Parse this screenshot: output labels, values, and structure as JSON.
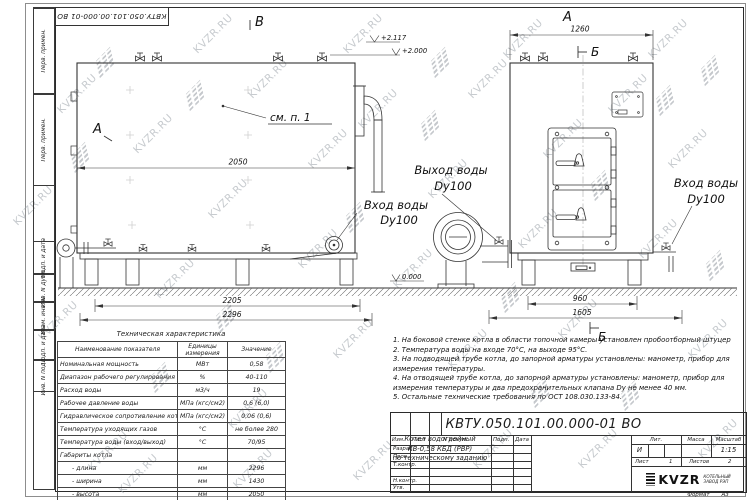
{
  "watermark": {
    "text": "KVZR.RU"
  },
  "frame_labels": {
    "perv_primen_1": "Перв. примен.",
    "perv_primen_2": "Перв. примен.",
    "podp_data_1": "Подп. и дата",
    "inv_dubl": "Инв. N дубл.",
    "vzam_inv": "Взам. инв. N",
    "podp_data_2": "Подп. и дата",
    "inv_podl": "Инв. N подл."
  },
  "drawing": {
    "marker_v": "В",
    "marker_a_side": "А",
    "marker_a_top": "А",
    "marker_b_top": "Б",
    "marker_b_bottom": "Б",
    "callout_see": "см. п. 1",
    "elev_top1": "+2.117",
    "elev_top2": "+2.000",
    "elev_zero": "0.000",
    "dim_2050": "2050",
    "dim_2205": "2205",
    "dim_2296": "2296",
    "dim_1260": "1260",
    "dim_960": "960",
    "dim_1605": "1605",
    "label_outlet_line1": "Выход воды",
    "label_outlet_line2": "Dy100",
    "label_inlet_left_line1": "Вход воды",
    "label_inlet_left_line2": "Dy100",
    "label_inlet_right_line1": "Вход воды",
    "label_inlet_right_line2": "Dy100"
  },
  "spec_table": {
    "title": "Техническая характеристика",
    "col_name": "Наименование показателя",
    "col_units": "Единицы измерения",
    "col_value": "Значение",
    "rows": [
      {
        "name": "Номинальная мощность",
        "units": "МВт",
        "value": "0,58"
      },
      {
        "name": "Диапазон рабочего регулирования",
        "units": "%",
        "value": "40-110"
      },
      {
        "name": "Расход воды",
        "units": "м3/ч",
        "value": "19"
      },
      {
        "name": "Рабочее давление воды",
        "units": "МПа (кгс/см2)",
        "value": "0,6 (6,0)"
      },
      {
        "name": "Гидравлическое сопротивление котла",
        "units": "МПа (кгс/см2)",
        "value": "0,06 (0,6)"
      },
      {
        "name": "Температура уходящих газов",
        "units": "°С",
        "value": "не более 280"
      },
      {
        "name": "Температура воды (вход/выход)",
        "units": "°С",
        "value": "70/95"
      },
      {
        "name": "Габариты котла",
        "units": "",
        "value": ""
      },
      {
        "name": "- длина",
        "units": "мм",
        "value": "2296",
        "indent": true
      },
      {
        "name": "- ширина",
        "units": "мм",
        "value": "1430",
        "indent": true
      },
      {
        "name": "- высота",
        "units": "мм",
        "value": "2050",
        "indent": true
      }
    ]
  },
  "notes": [
    "1.  На боковой стенке котла в области топочной камеры установлен пробоотборный штуцер",
    "2.  Температура воды на входе 70°С, на выходе 95°С.",
    "3.  На подводящей трубе котла, до запорной арматуры установлены: манометр, прибор для измерения температуры.",
    "4.  На отводящей трубе котла, до запорной арматуры установлены: манометр, прибор для измерения температуры и два предохранительных клапана Dу не менее 40 мм.",
    "5.  Остальные технические требования по ОСТ 108.030.133-84."
  ],
  "title_block": {
    "designation": "КВТУ.050.101.00.000-01 ВО",
    "cols": {
      "izm": "Изм.",
      "list": "Лист",
      "ndoc": "N докум.",
      "podp": "Подп.",
      "data": "Дата"
    },
    "rows": {
      "razrab": "Разраб.",
      "prov": "Пров.",
      "tkontr": "Т.контр.",
      "nkontr": "Н.контр.",
      "utv": "Утв."
    },
    "doc_name": [
      "Котел водогрейный",
      "КВ-0,58 КБД (РВР)",
      "по техническому заданию"
    ],
    "lit_label": "Лит.",
    "lit_value": "И",
    "mass_label": "Масса",
    "scale_label": "Масштаб",
    "scale_value": "1:15",
    "sheet_label": "Лист",
    "sheet_value": "1",
    "sheets_label": "Листов",
    "sheets_value": "2",
    "logo_text": "KVZR",
    "logo_sub1": "КОТЕЛЬНЫЙ",
    "logo_sub2": "ЗАВОД РЭП",
    "format_label": "Формат",
    "format_value": "А3"
  }
}
